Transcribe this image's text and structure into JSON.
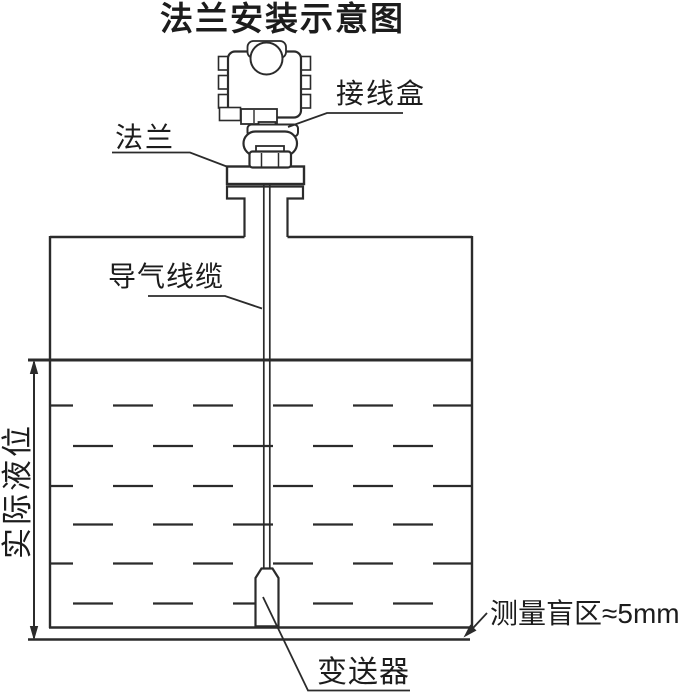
{
  "title": "法兰安装示意图",
  "diagram": {
    "type": "flange-installation-schematic",
    "labels": {
      "junction_box": "接线盒",
      "flange": "法兰",
      "vent_cable": "导气线缆",
      "actual_level": "实际液位",
      "blind_zone": "测量盲区≈5mm",
      "transmitter": "变送器"
    },
    "blind_zone_value": "≈5mm",
    "colors": {
      "line": "#2b2b2b",
      "text": "#1c1c1c",
      "background": "#ffffff"
    }
  }
}
